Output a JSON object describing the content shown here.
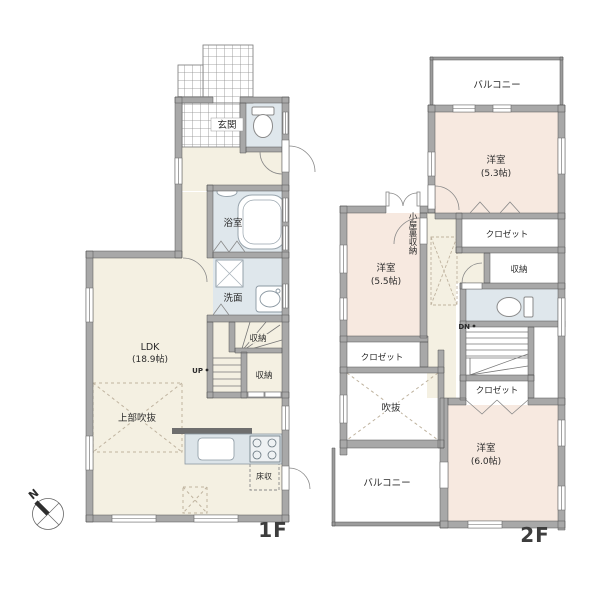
{
  "compass": {
    "north": "N"
  },
  "floor1": {
    "label": "1F",
    "genkan": "玄関",
    "bath": "浴室",
    "wash": "洗面",
    "ldk": "LDK",
    "ldk_size": "(18.9帖)",
    "storage_a": "収納",
    "storage_b": "収納",
    "void_above": "上部吹抜",
    "floor_storage": "床収",
    "up": "UP"
  },
  "floor2": {
    "label": "2F",
    "balcony_north": "バルコニー",
    "balcony_south": "バルコニー",
    "bedroom1": "洋室",
    "bedroom1_size": "(5.3帖)",
    "closet1": "クロゼット",
    "storage": "収納",
    "attic_storage": "小屋裏収納",
    "bedroom2": "洋室",
    "bedroom2_size": "(5.5帖)",
    "closet2": "クロゼット",
    "closet3": "クロゼット",
    "void": "吹抜",
    "bedroom3": "洋室",
    "bedroom3_size": "(6.0帖)",
    "dn": "DN"
  },
  "colors": {
    "wall": "#a8a8a8",
    "wall_outline": "#555555",
    "floor_cream": "#f4f0e2",
    "floor_pink": "#f7e9e0",
    "floor_wet": "#dfe7ec",
    "dash": "#bfb39f"
  }
}
